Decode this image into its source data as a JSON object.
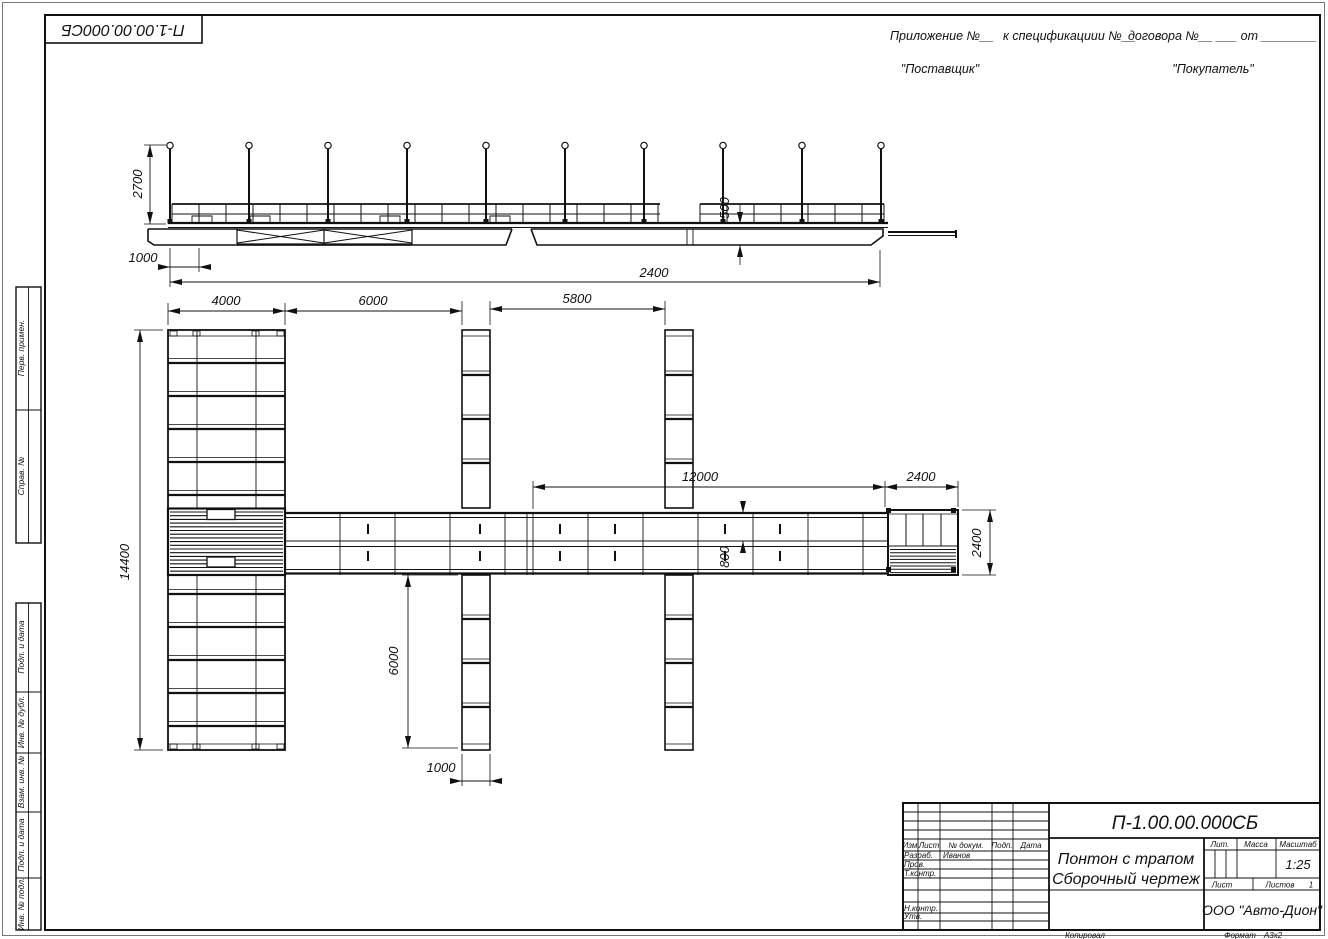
{
  "corner_stamp": {
    "doc_number": "П-1.00.00.000СБ"
  },
  "header": {
    "appendix": "Приложение №__",
    "spec": "к спецификациии №__",
    "contract": "договора №__ ___ от ________",
    "supplier": "\"Поставщик\"",
    "buyer": "\"Покупатель\""
  },
  "margin": {
    "perv_primen": "Перв. примен.",
    "sprav_no": "Справ. №",
    "podp_data_1": "Подп. и дата",
    "inv_dubl": "Инв. № дубл.",
    "vzam_inv": "Взам. инв. №",
    "podp_data_2": "Подп. и дата",
    "inv_podl": "Инв. № подл."
  },
  "dimensions": {
    "side": {
      "pole_height": "2700",
      "ramp_offset": "1000",
      "freeboard": "500",
      "section": "2400"
    },
    "plan": {
      "pontoon_width": "4000",
      "gap1": "6000",
      "gap2": "5800",
      "walkway_length": "12000",
      "platform_length": "2400",
      "pontoon_length": "14400",
      "lane_width": "800",
      "platform_width": "2400",
      "finger_length": "6000",
      "finger_width": "1000"
    }
  },
  "title_block": {
    "doc_number": "П-1.00.00.000СБ",
    "title_line1": "Понтон с трапом",
    "title_line2": "Сборочный чертеж",
    "cols": {
      "izm": "Изм",
      "list": "Лист",
      "doc": "№ докум.",
      "podp": "Подп.",
      "data": "Дата"
    },
    "rows": {
      "razrab": "Разраб.",
      "razrab_name": "Иванов",
      "prov": "Пров.",
      "tkontr": "Т.контр.",
      "nkontr": "Н.контр.",
      "utv": "Утв."
    },
    "lit": "Лит.",
    "massa": "Масса",
    "masshtab": "Масштаб",
    "scale_value": "1:25",
    "list_label": "Лист",
    "listov_label": "Листов",
    "listov_value": "1",
    "company": "ООО \"Авто-Дион\"",
    "kopiroval": "Копировал",
    "format_label": "Формат",
    "format_value": "А3х2"
  }
}
